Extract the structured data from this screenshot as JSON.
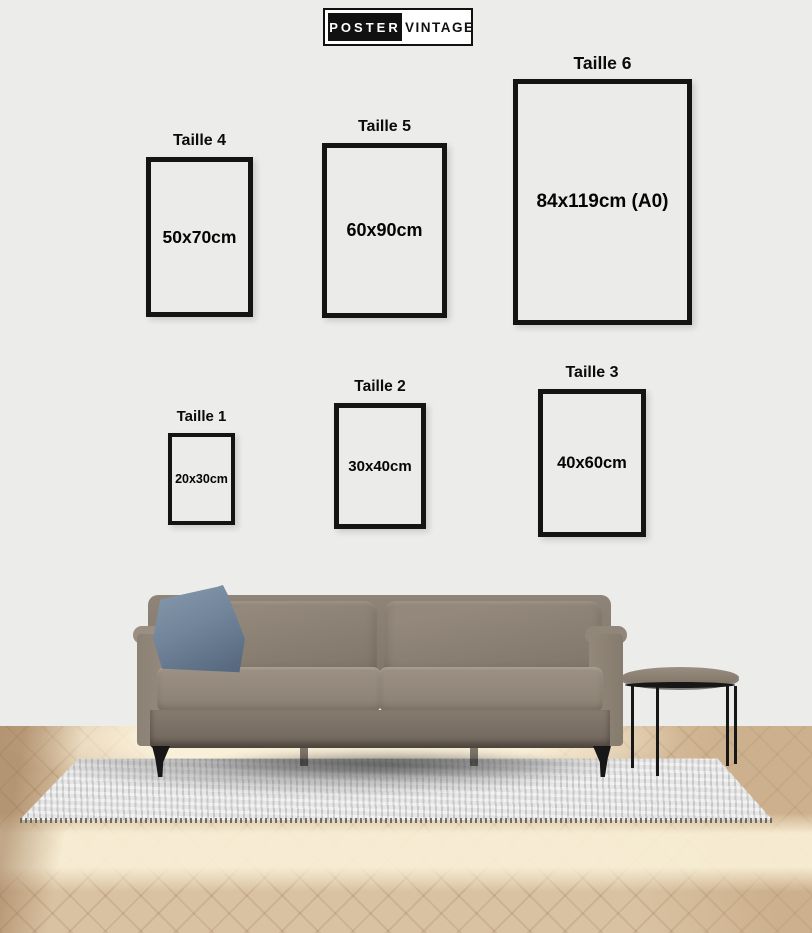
{
  "brand": {
    "primary": "POSTER",
    "secondary": "VINTAGE"
  },
  "size_guide": {
    "sizes": [
      {
        "label": "Taille 1",
        "dimensions": "20x30cm"
      },
      {
        "label": "Taille 2",
        "dimensions": "30x40cm"
      },
      {
        "label": "Taille 3",
        "dimensions": "40x60cm"
      },
      {
        "label": "Taille 4",
        "dimensions": "50x70cm"
      },
      {
        "label": "Taille 5",
        "dimensions": "60x90cm"
      },
      {
        "label": "Taille 6",
        "dimensions": "84x119cm (A0)"
      }
    ]
  },
  "colors": {
    "logo_black": "#111111",
    "frame_border": "#141414",
    "wall": "#ececeb",
    "frame_interior": "#ebebea",
    "label_text": "#0b0b0b",
    "sofa_taupe": "#8d8275",
    "sofa_dark": "#746a5e",
    "pillow_blue": "#72859a",
    "metal_leg": "#171717",
    "wood_floor": "#d9c2a2",
    "wood_light": "#f6ecd2",
    "rug_gray": "#e6e6e6",
    "table_top": "#8f8375"
  }
}
